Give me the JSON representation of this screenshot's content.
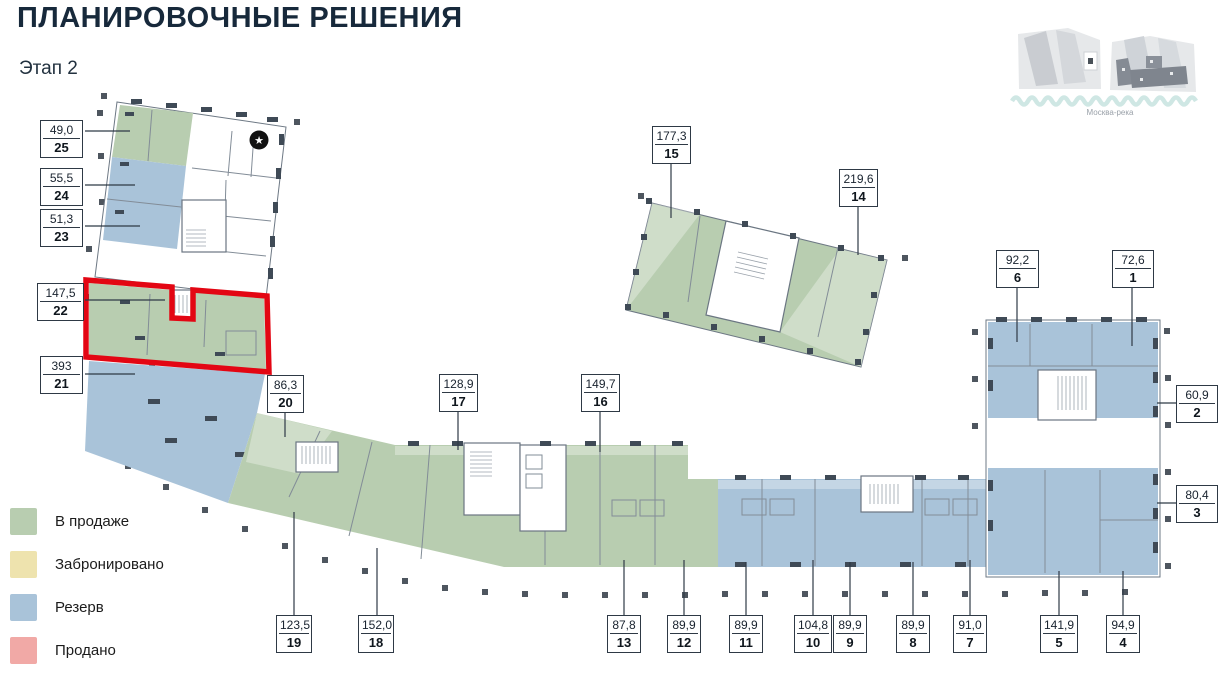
{
  "header": {
    "title": "ПЛАНИРОВОЧНЫЕ РЕШЕНИЯ",
    "subtitle": "Этап 2"
  },
  "map": {
    "caption": "Москва-река"
  },
  "legend": {
    "items": [
      {
        "label": "В продаже",
        "color": "#b8cdb0"
      },
      {
        "label": "Забронировано",
        "color": "#eee3ae"
      },
      {
        "label": "Резерв",
        "color": "#a9c3d9"
      },
      {
        "label": "Продано",
        "color": "#f1a9a6"
      }
    ]
  },
  "highlight": {
    "unit": "22",
    "color": "#e30613"
  },
  "star_marker": "★",
  "units": {
    "1": {
      "area": "72,6",
      "number": "1"
    },
    "2": {
      "area": "60,9",
      "number": "2"
    },
    "3": {
      "area": "80,4",
      "number": "3"
    },
    "4": {
      "area": "94,9",
      "number": "4"
    },
    "5": {
      "area": "141,9",
      "number": "5"
    },
    "6": {
      "area": "92,2",
      "number": "6"
    },
    "7": {
      "area": "91,0",
      "number": "7"
    },
    "8": {
      "area": "89,9",
      "number": "8"
    },
    "9": {
      "area": "89,9",
      "number": "9"
    },
    "10": {
      "area": "104,8",
      "number": "10"
    },
    "11": {
      "area": "89,9",
      "number": "11"
    },
    "12": {
      "area": "89,9",
      "number": "12"
    },
    "13": {
      "area": "87,8",
      "number": "13"
    },
    "14": {
      "area": "219,6",
      "number": "14"
    },
    "15": {
      "area": "177,3",
      "number": "15"
    },
    "16": {
      "area": "149,7",
      "number": "16"
    },
    "17": {
      "area": "128,9",
      "number": "17"
    },
    "18": {
      "area": "152,0",
      "number": "18"
    },
    "19": {
      "area": "123,5",
      "number": "19"
    },
    "20": {
      "area": "86,3",
      "number": "20"
    },
    "21": {
      "area": "393",
      "number": "21"
    },
    "22": {
      "area": "147,5",
      "number": "22"
    },
    "23": {
      "area": "51,3",
      "number": "23"
    },
    "24": {
      "area": "55,5",
      "number": "24"
    },
    "25": {
      "area": "49,0",
      "number": "25"
    }
  }
}
